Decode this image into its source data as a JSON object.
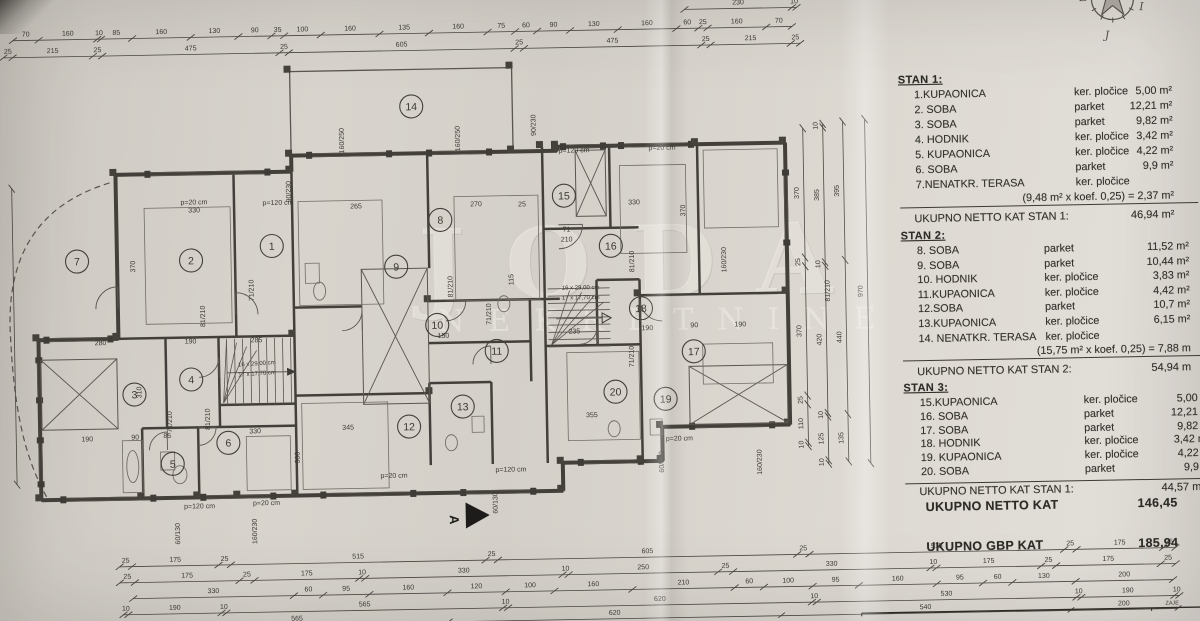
{
  "photo": {
    "subject": "architectural floor plan sheet, first floor (kat), three apartments"
  },
  "compass": {
    "west": "Z",
    "east": "I",
    "south": "J"
  },
  "watermark": {
    "line1": "JODA",
    "line2": "NEKRETNINE"
  },
  "section_marker": "A",
  "corner_note": "ZAJE",
  "tables": {
    "sections": [
      {
        "title": "STAN 1:",
        "rows": [
          {
            "name": "1.KUPAONICA",
            "material": "ker. pločice",
            "area": "5,00 m²"
          },
          {
            "name": "2. SOBA",
            "material": "parket",
            "area": "12,21 m²"
          },
          {
            "name": "3. SOBA",
            "material": "parket",
            "area": "9,82 m²"
          },
          {
            "name": "4. HODNIK",
            "material": "ker. pločice",
            "area": "3,42 m²"
          },
          {
            "name": "5. KUPAONICA",
            "material": "ker. pločice",
            "area": "4,22 m²"
          },
          {
            "name": "6. SOBA",
            "material": "parket",
            "area": "9,9 m²"
          },
          {
            "name": "7.NENATKR. TERASA",
            "material": "ker. pločice",
            "area": ""
          }
        ],
        "note": "(9,48 m² x koef. 0,25) = 2,37 m²",
        "total_label": "UKUPNO NETTO KAT STAN 1:",
        "total_value": "46,94 m²"
      },
      {
        "title": "STAN 2:",
        "rows": [
          {
            "name": "8. SOBA",
            "material": "parket",
            "area": "11,52 m²"
          },
          {
            "name": "9. SOBA",
            "material": "parket",
            "area": "10,44 m²"
          },
          {
            "name": "10. HODNIK",
            "material": "ker. pločice",
            "area": "3,83 m²"
          },
          {
            "name": "11.KUPAONICA",
            "material": "ker. pločice",
            "area": "4,42 m²"
          },
          {
            "name": "12.SOBA",
            "material": "parket",
            "area": "10,7 m²"
          },
          {
            "name": "13.KUPAONICA",
            "material": "ker. pločice",
            "area": "6,15 m²"
          },
          {
            "name": "14. NENATKR. TERASA",
            "material": "ker. pločice",
            "area": ""
          }
        ],
        "note": "(15,75 m² x koef. 0,25) = 7,88 m",
        "total_label": "UKUPNO NETTO KAT STAN 2:",
        "total_value": "54,94 m"
      },
      {
        "title": "STAN 3:",
        "rows": [
          {
            "name": "15.KUPAONICA",
            "material": "ker. pločice",
            "area": "5,00 m"
          },
          {
            "name": "16. SOBA",
            "material": "parket",
            "area": "12,21 m"
          },
          {
            "name": "17. SOBA",
            "material": "parket",
            "area": "9,82 m"
          },
          {
            "name": "18. HODNIK",
            "material": "ker. pločice",
            "area": "3,42 m²"
          },
          {
            "name": "19. KUPAONICA",
            "material": "ker. pločice",
            "area": "4,22 m"
          },
          {
            "name": "20. SOBA",
            "material": "parket",
            "area": "9,9 m"
          }
        ],
        "note": "",
        "total_label": "UKUPNO NETTO KAT STAN 1:",
        "total_value": "44,57 m"
      }
    ]
  },
  "totals": [
    {
      "label": "UKUPNO NETTO KAT",
      "value": "146,45"
    },
    {
      "label": "UKUPNO GBP KAT",
      "value": "185,94"
    }
  ],
  "plan": {
    "stair_text": [
      "16 x 29,00 cm",
      "17 x 17,70 cm"
    ],
    "rooms": [
      {
        "n": "1",
        "x": 273,
        "y": 240
      },
      {
        "n": "2",
        "x": 192,
        "y": 253
      },
      {
        "n": "3",
        "x": 133,
        "y": 386
      },
      {
        "n": "4",
        "x": 190,
        "y": 372
      },
      {
        "n": "5",
        "x": 170,
        "y": 456
      },
      {
        "n": "6",
        "x": 226,
        "y": 436
      },
      {
        "n": "7",
        "x": 78,
        "y": 252
      },
      {
        "n": "8",
        "x": 442,
        "y": 217
      },
      {
        "n": "9",
        "x": 397,
        "y": 263
      },
      {
        "n": "10",
        "x": 437,
        "y": 322
      },
      {
        "n": "11",
        "x": 496,
        "y": 349
      },
      {
        "n": "12",
        "x": 407,
        "y": 423
      },
      {
        "n": "13",
        "x": 461,
        "y": 404
      },
      {
        "n": "14",
        "x": 415,
        "y": 103
      },
      {
        "n": "15",
        "x": 566,
        "y": 195
      },
      {
        "n": "16",
        "x": 612,
        "y": 246
      },
      {
        "n": "17",
        "x": 693,
        "y": 353
      },
      {
        "n": "18",
        "x": 641,
        "y": 309
      },
      {
        "n": "19",
        "x": 664,
        "y": 400
      },
      {
        "n": "20",
        "x": 614,
        "y": 392
      }
    ],
    "labels": [
      [
        "p=20 cm",
        196,
        197
      ],
      [
        "330",
        196,
        205
      ],
      [
        "p=120 cm",
        280,
        199
      ],
      [
        "90/230",
        293,
        186,
        1
      ],
      [
        "160/250",
        347,
        136,
        1
      ],
      [
        "160/250",
        463,
        136,
        1
      ],
      [
        "90/230",
        539,
        124,
        1
      ],
      [
        "p=120 cm",
        577,
        152
      ],
      [
        "p=20 cm",
        665,
        151
      ],
      [
        "160/230",
        727,
        262,
        1
      ],
      [
        "330",
        636,
        205
      ],
      [
        "370",
        687,
        212,
        1
      ],
      [
        "265",
        358,
        204
      ],
      [
        "270",
        478,
        204
      ],
      [
        "25",
        524,
        205
      ],
      [
        "370",
        136,
        258,
        1
      ],
      [
        "310",
        140,
        384,
        1
      ],
      [
        "285",
        256,
        336
      ],
      [
        "190",
        190,
        336
      ],
      [
        "280",
        100,
        336
      ],
      [
        "190",
        85,
        432
      ],
      [
        "90",
        133,
        431
      ],
      [
        "85",
        165,
        430
      ],
      [
        "330",
        253,
        427
      ],
      [
        "300",
        297,
        452,
        1
      ],
      [
        "345",
        346,
        425
      ],
      [
        "355",
        590,
        417
      ],
      [
        "235",
        574,
        333
      ],
      [
        "190",
        647,
        331
      ],
      [
        "90",
        694,
        329
      ],
      [
        "190",
        740,
        329
      ],
      [
        "150",
        443,
        335
      ],
      [
        "115",
        514,
        278,
        1
      ],
      [
        "81/210",
        205,
        309,
        1
      ],
      [
        "71/210",
        170,
        414,
        1
      ],
      [
        "81/210",
        208,
        412,
        1
      ],
      [
        "71/210",
        254,
        284,
        1
      ],
      [
        "81/210",
        453,
        284,
        1
      ],
      [
        "71/210",
        491,
        312,
        1
      ],
      [
        "81/210",
        635,
        262,
        1
      ],
      [
        "71/210",
        633,
        357,
        1
      ],
      [
        "81/210",
        830,
        295,
        1
      ],
      [
        "71",
        568,
        231
      ],
      [
        "210",
        568,
        241
      ],
      [
        "p=120 cm",
        196,
        501
      ],
      [
        "p=20 cm",
        263,
        499
      ],
      [
        "p=20 cm",
        391,
        474
      ],
      [
        "p=120 cm",
        508,
        470
      ],
      [
        "p=20 cm",
        677,
        442
      ],
      [
        "160/230",
        253,
        525,
        1
      ],
      [
        "60/130",
        176,
        526,
        1
      ],
      [
        "60/130",
        494,
        501,
        1
      ],
      [
        "60/130",
        661,
        463,
        1
      ],
      [
        "160/230",
        759,
        465,
        1
      ]
    ],
    "chains": [
      [
        690,
        11,
        112,
        "h",
        [
          230,
          10
        ]
      ],
      [
        18,
        30,
        779,
        "h",
        [
          70,
          160,
          10,
          85,
          160,
          130,
          90,
          35,
          100,
          160,
          135,
          160,
          75,
          60,
          90,
          130,
          160,
          60,
          25,
          160,
          70
        ]
      ],
      [
        8,
        47,
        797,
        "h",
        [
          25,
          215,
          25,
          475,
          25,
          605,
          25,
          475,
          25,
          215,
          25
        ]
      ],
      [
        115,
        558,
        1056,
        "h",
        [
          25,
          175,
          25,
          515,
          25,
          605,
          25,
          515,
          25,
          175,
          25
        ]
      ],
      [
        115,
        574,
        1056,
        "h",
        [
          25,
          175,
          25,
          175,
          10,
          330,
          10,
          250,
          25,
          330,
          10,
          175,
          25,
          175,
          25
        ]
      ],
      [
        128,
        590,
        1040,
        "h",
        [
          330,
          60,
          95,
          160,
          120,
          100,
          160,
          210,
          60,
          100,
          95,
          160,
          95,
          60,
          130,
          200
        ]
      ],
      [
        118,
        606,
        1056,
        "h",
        [
          10,
          190,
          10,
          565,
          10,
          620,
          10,
          530,
          10,
          190,
          10
        ]
      ],
      [
        140,
        619,
        1032,
        "h",
        [
          565,
          620,
          540,
          200
        ]
      ],
      [
        806,
        132,
        318,
        "v",
        [
          370,
          25,
          370,
          25,
          110,
          10
        ]
      ],
      [
        826,
        128,
        340,
        "v",
        [
          10,
          385,
          10,
          420,
          10,
          125,
          10
        ]
      ],
      [
        846,
        126,
        340,
        "v",
        [
          395,
          440,
          135
        ]
      ],
      [
        868,
        124,
        344,
        "v",
        [
          970
        ]
      ],
      [
        14,
        178,
        296,
        "v",
        []
      ]
    ]
  }
}
